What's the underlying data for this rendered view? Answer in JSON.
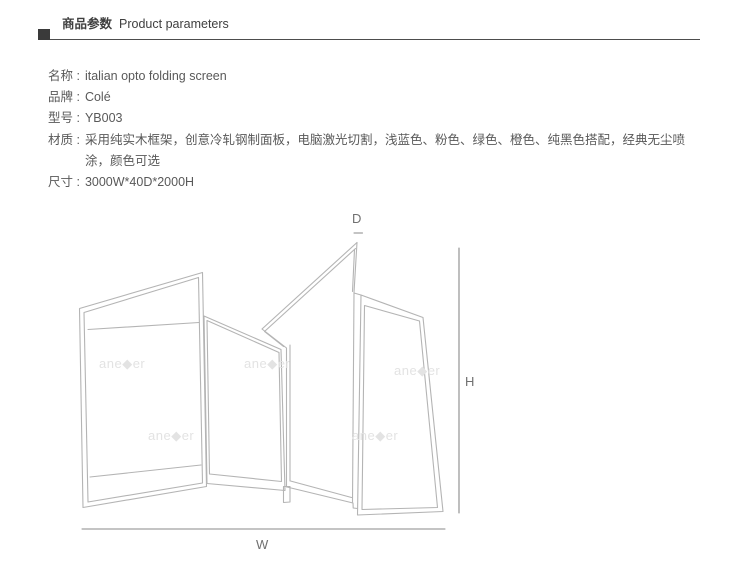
{
  "header": {
    "title_zh": "商品参数",
    "title_en": "Product parameters"
  },
  "specs": [
    {
      "label": "名称 :",
      "value": "italian opto folding screen"
    },
    {
      "label": "品牌 :",
      "value": "Colé"
    },
    {
      "label": "型号 :",
      "value": "YB003"
    },
    {
      "label": "材质 :",
      "value": "采用纯实木框架，创意冷轧钢制面板，电脑激光切割，浅蓝色、粉色、绿色、橙色、纯黑色搭配，经典无尘喷涂，颜色可选"
    },
    {
      "label": "尺寸 :",
      "value": "3000W*40D*2000H"
    }
  ],
  "diagram": {
    "labels": {
      "depth": "D",
      "height": "H",
      "width": "W"
    },
    "watermark": "ane◆er",
    "colors": {
      "outline": "#b4b4b4",
      "dimension": "#8a8a8a",
      "dim_label": "#707070",
      "watermark": "#e3e3e3"
    }
  },
  "colors": {
    "heading": "#3f3f3f",
    "body_text": "#595959",
    "rule": "#4d4d4d",
    "bullet": "#3a3a3a"
  }
}
